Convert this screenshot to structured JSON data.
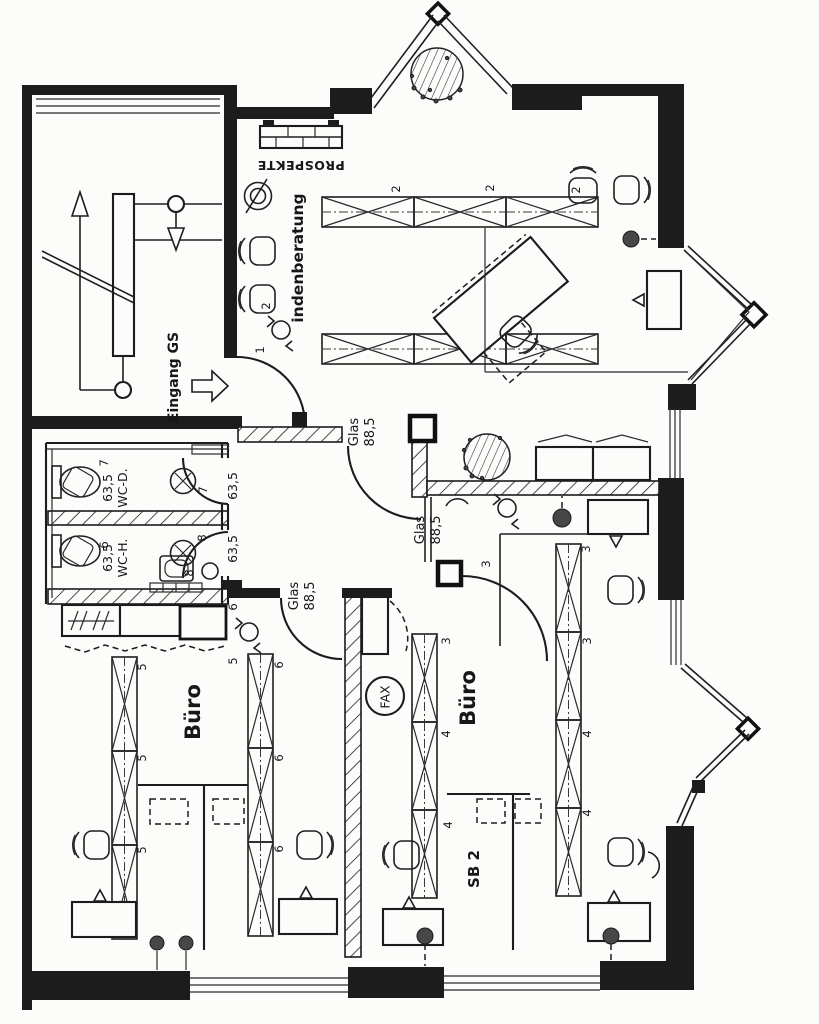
{
  "labels": {
    "prospekte": "PROSPEKTE",
    "consultation_room": "indenberatung",
    "entrance": "Eingang GS",
    "glass": "Glas",
    "glass_width": "88,5",
    "wc_width": "63,5",
    "wc_women": "WC-D.",
    "wc_men": "WC-H.",
    "office": "Büro",
    "sb2_room": "SB 2",
    "fax": "FAX"
  },
  "numbers": {
    "n1": "1",
    "n2": "2",
    "n3": "3",
    "n4": "4",
    "n5": "5",
    "n6": "6",
    "n7": "7",
    "n8": "8"
  }
}
